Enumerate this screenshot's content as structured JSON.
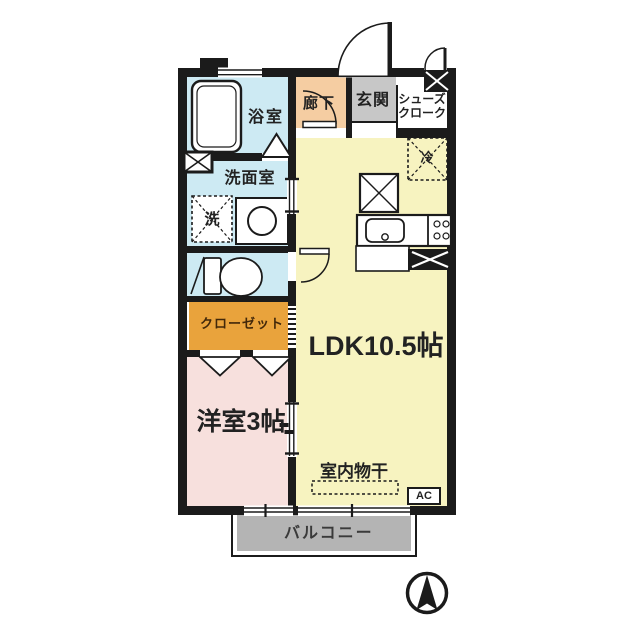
{
  "labels": {
    "bath": "浴室",
    "washroom": "洗面室",
    "washer": "洗",
    "hallway": "廊下",
    "entrance": "玄関",
    "shoes_line1": "シューズ",
    "shoes_line2": "クローク",
    "fridge": "冷",
    "ldk": "LDK10.5帖",
    "closet": "クローゼット",
    "western": "洋室3帖",
    "drying": "室内物干",
    "ac": "AC",
    "balcony": "バルコニー"
  },
  "colors": {
    "wall": "#1b1b1b",
    "bath": "#cdeaf3",
    "hall": "#f5cda2",
    "genkan": "#c7c7c7",
    "ldk": "#f7f3c0",
    "closet": "#e9a33c",
    "western": "#f7e0dd",
    "balcony": "#b4b4b4"
  },
  "icons": {
    "compass": "north-arrow",
    "fixtures": [
      "bathtub",
      "washing-machine",
      "basin",
      "toilet",
      "kitchen-sink",
      "stove",
      "refrigerator"
    ]
  }
}
